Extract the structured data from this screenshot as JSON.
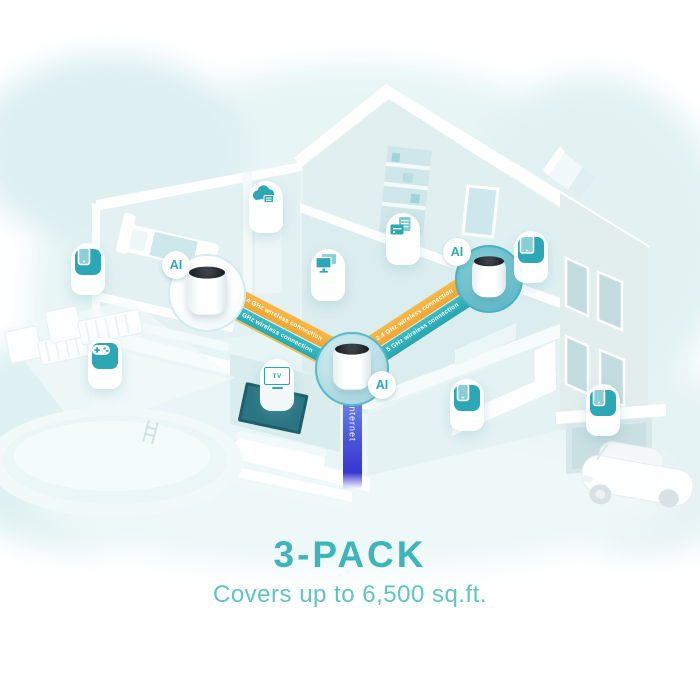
{
  "product": {
    "unit_badge": "AI",
    "caption_title": "3-PACK",
    "caption_subtitle": "Covers up to 6,500 sq.ft."
  },
  "connections": {
    "chevron_back": "‹‹‹",
    "chevron_forward": "›››",
    "left": [
      {
        "label": "2.4 GHz wireless connection"
      },
      {
        "label": "5 GHz wireless connection"
      }
    ],
    "right": [
      {
        "label": "2.4 GHz wireless connection"
      },
      {
        "label": "5 GHz wireless connection"
      }
    ],
    "internet_label": "Internet"
  },
  "icons": [
    {
      "name": "smartphone-icon"
    },
    {
      "name": "game-controller-icon"
    },
    {
      "name": "cloud-appliance-icon"
    },
    {
      "name": "dual-monitor-icon"
    },
    {
      "name": "printer-icon"
    },
    {
      "name": "tablet-icon"
    },
    {
      "name": "tv-icon",
      "text": "TV"
    },
    {
      "name": "smartphone-icon"
    },
    {
      "name": "smartphone-icon"
    }
  ],
  "colors": {
    "accent_teal": "#3db6bb",
    "subtitle_teal": "#5ec4c8",
    "band_orange": "#f0a938",
    "band_teal": "#2fb0ba",
    "internet_blue_top": "#6d87e8",
    "internet_blue_bottom": "#3936cf",
    "icon_teal": "#2ba7b6",
    "house_tint": "#e3f2f3"
  }
}
